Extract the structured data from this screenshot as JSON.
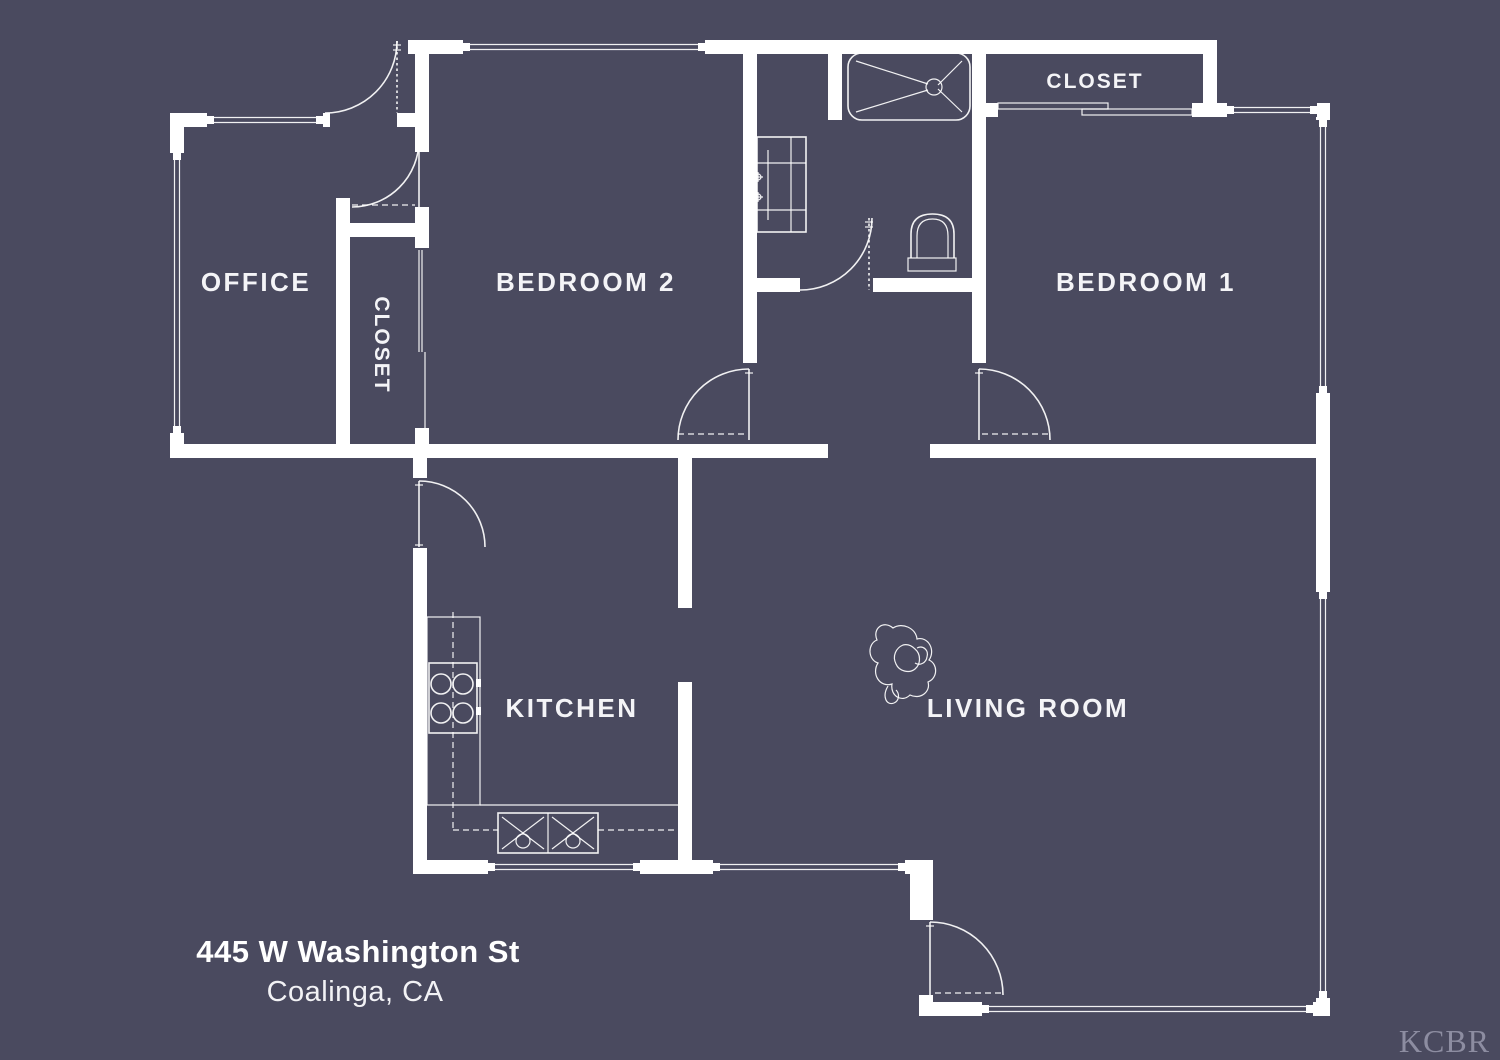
{
  "plan": {
    "background_color": "#4a4a5f",
    "line_color": "#ffffff",
    "label_color": "#f4f4f7",
    "watermark_color": "#8d8da1",
    "rooms": [
      {
        "id": "office",
        "label": "OFFICE"
      },
      {
        "id": "hall-closet",
        "label": "CLOSET"
      },
      {
        "id": "bedroom-2",
        "label": "BEDROOM 2"
      },
      {
        "id": "bedroom-1-closet",
        "label": "CLOSET"
      },
      {
        "id": "bedroom-1",
        "label": "BEDROOM 1"
      },
      {
        "id": "kitchen",
        "label": "KITCHEN"
      },
      {
        "id": "living-room",
        "label": "LIVING ROOM"
      }
    ],
    "address": {
      "line1": "445 W Washington St",
      "line2": "Coalinga, CA"
    },
    "watermark": "KCBR"
  }
}
